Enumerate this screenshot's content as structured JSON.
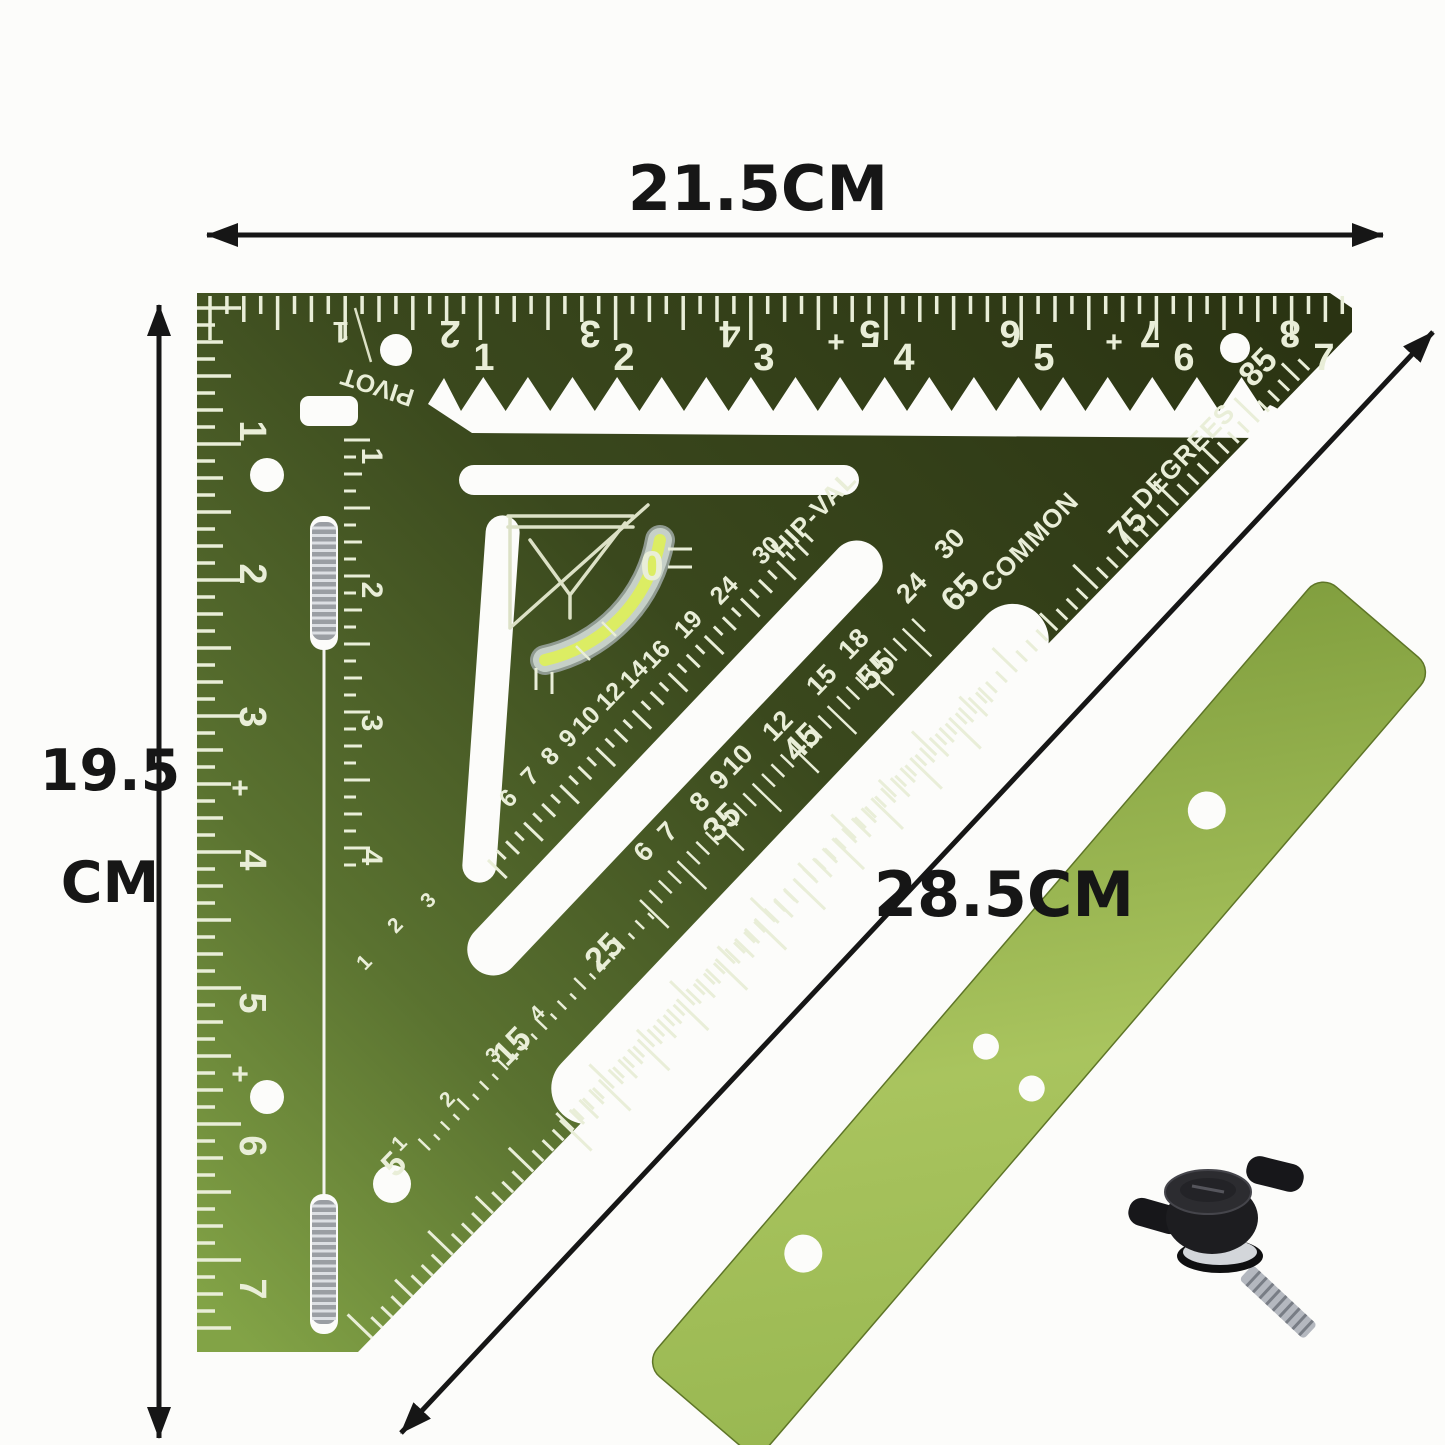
{
  "annotations": {
    "width_label": "21.5CM",
    "height_label_line1": "19.5",
    "height_label_line2": "CM",
    "hypotenuse_label": "28.5CM"
  },
  "square": {
    "pivot_label": "PIVOT",
    "pivot_number": "1",
    "degrees_label": "DEGREES",
    "common_label": "COMMON",
    "hipval_label": "HIP-VAL",
    "vial_zero": "0",
    "corner_degrees": [
      "85",
      "75"
    ],
    "top_scale_upright": [
      "1",
      "2",
      "3",
      "4",
      "5",
      "6",
      "7"
    ],
    "top_scale_inverted": [
      "2",
      "3",
      "4",
      "5",
      "6",
      "7",
      "8"
    ],
    "top_plus_marks": [
      "+",
      "+"
    ],
    "left_scale_outer": [
      "1",
      "2",
      "3",
      "4",
      "5",
      "6",
      "7"
    ],
    "left_plus_marks": [
      "+",
      "+"
    ],
    "left_scale_inner": [
      "1",
      "2",
      "3",
      "4"
    ],
    "degrees_scale": [
      "65",
      "55",
      "45",
      "35",
      "25",
      "15",
      "5"
    ],
    "common_scale": [
      "30",
      "24",
      "18",
      "15",
      "12",
      "10",
      "9",
      "8",
      "7",
      "6"
    ],
    "hipval_scale": [
      "30",
      "24",
      "19",
      "16",
      "14",
      "12",
      "10",
      "9",
      "8",
      "7",
      "6"
    ],
    "inner_cm_row_a": [
      "1",
      "2",
      "3"
    ],
    "inner_cm_row_b": [
      "1",
      "2",
      "3",
      "4"
    ]
  },
  "colors": {
    "square_dark": "#2a3312",
    "square_mid": "#3a481d",
    "square_light": "#82a346",
    "bar_dark": "#7e9c3c",
    "bar_light": "#a9c45e",
    "marking": "#e9eed8",
    "vial_fluid": "#dced63",
    "vial_tube": "#c6d0c8",
    "annotation": "#161616",
    "knob": "#1d1d20"
  }
}
